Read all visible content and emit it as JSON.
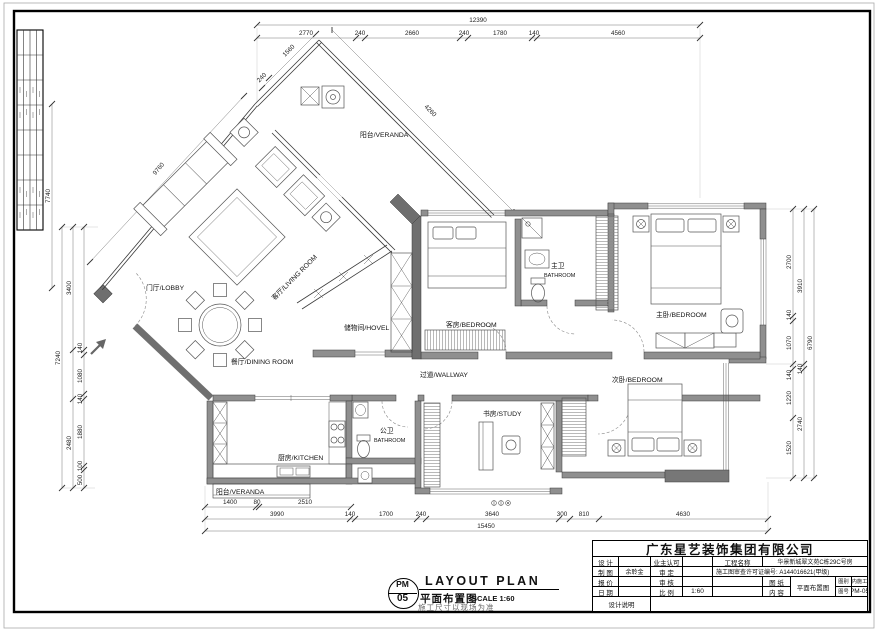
{
  "rooms": {
    "veranda_top": "阳台/VERANDA",
    "living": "客厅/LIVING ROOM",
    "lobby": "门厅/LOBBY",
    "dining": "餐厅/DINING ROOM",
    "storage": "储物间/HOVEL",
    "guest": "客房/BEDROOM",
    "mbath_zh": "主卫",
    "mbath_en": "BATHROOM",
    "master": "主卧/BEDROOM",
    "hall": "过道/WALLWAY",
    "second": "次卧/BEDROOM",
    "study": "书房/STUDY",
    "pbath_zh": "公卫",
    "pbath_en": "BATHROOM",
    "kitchen": "厨房/KITCHEN",
    "veranda_bottom": "阳台/VERANDA"
  },
  "dims": {
    "top_total": "12390",
    "top": [
      "2770",
      "240",
      "2660",
      "240",
      "1780",
      "140",
      "4560"
    ],
    "diag_small": [
      "1560",
      "240"
    ],
    "veranda_side": "4260",
    "diag_left": "9760",
    "left_outer_diag": "7740",
    "left_total": "7240",
    "left_mid": [
      "3400",
      "2480"
    ],
    "left_inner": [
      "140",
      "1080",
      "140",
      "1880",
      "100",
      "500"
    ],
    "right_inner": [
      "2700",
      "140",
      "1070",
      "140",
      "1220",
      "1520"
    ],
    "right_mid": [
      "3910",
      "140",
      "2740"
    ],
    "right_outer": "6790",
    "bottom_r1": [
      "1400",
      "80",
      "2510"
    ],
    "bottom_r2": [
      "3990",
      "140",
      "1700",
      "240",
      "3640",
      "300",
      "810",
      "4630"
    ],
    "bottom_total": "15450"
  },
  "stamp": {
    "code_top": "PM",
    "code_bottom": "05",
    "title_en": "LAYOUT PLAN",
    "title_zh": "平面布置图",
    "scale": "SCALE 1:60",
    "note": "施工尺寸以现场为准"
  },
  "titleblock": {
    "company": "广东星艺装饰集团有限公司",
    "design": "设 计",
    "owner": "业主认可",
    "project_label": "工程名称",
    "project_value": "华景新城翠文苑C栋29C号房",
    "draft": "制 图",
    "draft_value": "余聆金",
    "approve": "审 定",
    "permit": "施工图审查许可证编号: A144016621(甲级)",
    "quote": "报 价",
    "check": "审 核",
    "sheet": "图 纸",
    "content": "内 容",
    "sheet_value": "平面布置图",
    "cat_label": "图别",
    "cat_value": "室内施工图",
    "date": "日 期",
    "scale_label": "比 例",
    "scale_value": "1:60",
    "num_label": "图号",
    "num_value": "PM-05",
    "note": "设计说明"
  }
}
